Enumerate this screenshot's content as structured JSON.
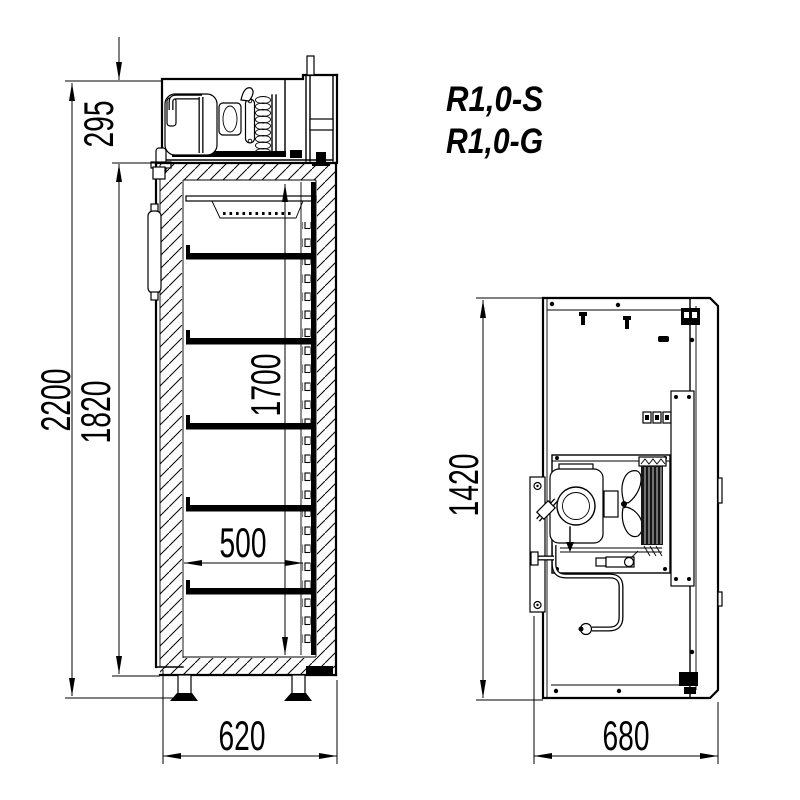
{
  "page": {
    "background": "#ffffff"
  },
  "drawing": {
    "colors": {
      "line": "#000000",
      "fill": "#ffffff"
    },
    "models": {
      "model_1": "R1,0-S",
      "model_2": "R1,0-G"
    },
    "side_view": {
      "dims": {
        "overall_height": "2200",
        "machine_compartment_height": "295",
        "body_height": "1820",
        "interior_height": "1700",
        "shelf_depth": "500",
        "overall_depth": "620"
      }
    },
    "rear_view": {
      "dims": {
        "unit_height": "1420",
        "overall_width": "680"
      }
    }
  }
}
